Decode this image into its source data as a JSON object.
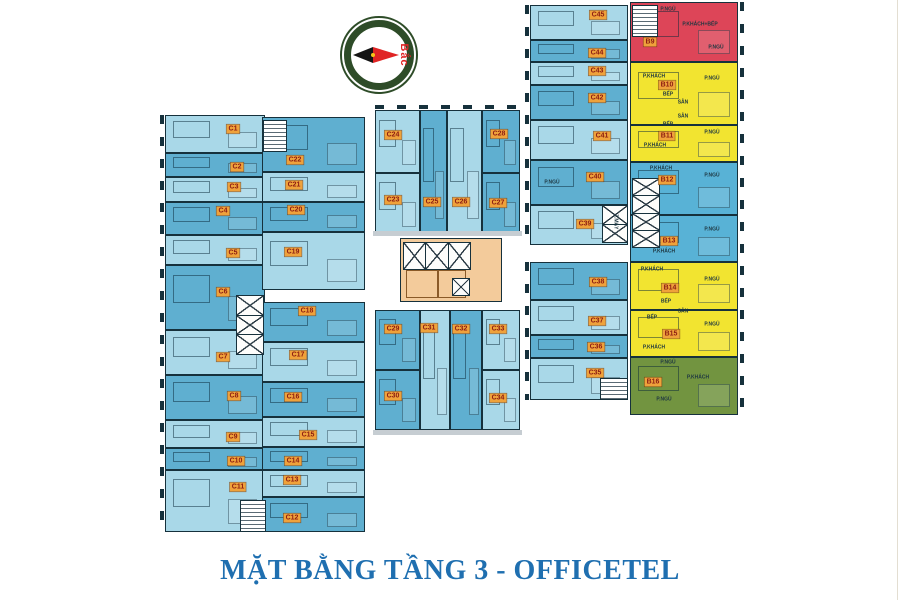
{
  "title": {
    "text": "MẶT BẰNG TẦNG 3 - OFFICETEL",
    "color": "#1f6fb0"
  },
  "compass": {
    "label": "Bắc"
  },
  "colors": {
    "light": "#a9d8e8",
    "mid": "#5fafd0",
    "red": "#dd4558",
    "yellow": "#f2e430",
    "green": "#729440",
    "blue": "#58b2d6",
    "core": "#f3cb9b",
    "wall": "#16313c",
    "badge_bg": "#efa23b",
    "badge_text": "#8c1c12"
  },
  "units": [
    {
      "id": "C1",
      "x": 165,
      "y": 115,
      "w": 100,
      "h": 38,
      "fill": "light",
      "lx": 233,
      "ly": 129
    },
    {
      "id": "C2",
      "x": 165,
      "y": 153,
      "w": 100,
      "h": 24,
      "fill": "mid",
      "lx": 237,
      "ly": 167
    },
    {
      "id": "C3",
      "x": 165,
      "y": 177,
      "w": 100,
      "h": 25,
      "fill": "light",
      "lx": 234,
      "ly": 187
    },
    {
      "id": "C4",
      "x": 165,
      "y": 202,
      "w": 100,
      "h": 33,
      "fill": "mid",
      "lx": 223,
      "ly": 211
    },
    {
      "id": "C5",
      "x": 165,
      "y": 235,
      "w": 100,
      "h": 30,
      "fill": "light",
      "lx": 233,
      "ly": 253
    },
    {
      "id": "C6",
      "x": 165,
      "y": 265,
      "w": 100,
      "h": 65,
      "fill": "mid",
      "lx": 223,
      "ly": 292
    },
    {
      "id": "C7",
      "x": 165,
      "y": 330,
      "w": 100,
      "h": 45,
      "fill": "light",
      "lx": 223,
      "ly": 357
    },
    {
      "id": "C8",
      "x": 165,
      "y": 375,
      "w": 100,
      "h": 45,
      "fill": "mid",
      "lx": 234,
      "ly": 396
    },
    {
      "id": "C9",
      "x": 165,
      "y": 420,
      "w": 100,
      "h": 28,
      "fill": "light",
      "lx": 233,
      "ly": 437
    },
    {
      "id": "C10",
      "x": 165,
      "y": 448,
      "w": 100,
      "h": 22,
      "fill": "mid",
      "lx": 236,
      "ly": 461
    },
    {
      "id": "C11",
      "x": 165,
      "y": 470,
      "w": 100,
      "h": 62,
      "fill": "light",
      "lx": 238,
      "ly": 487
    },
    {
      "id": "C22",
      "x": 262,
      "y": 117,
      "w": 103,
      "h": 55,
      "fill": "mid",
      "lx": 295,
      "ly": 160
    },
    {
      "id": "C21",
      "x": 262,
      "y": 172,
      "w": 103,
      "h": 30,
      "fill": "light",
      "lx": 294,
      "ly": 185
    },
    {
      "id": "C20",
      "x": 262,
      "y": 202,
      "w": 103,
      "h": 30,
      "fill": "mid",
      "lx": 296,
      "ly": 210
    },
    {
      "id": "C19",
      "x": 262,
      "y": 232,
      "w": 103,
      "h": 58,
      "fill": "light",
      "lx": 293,
      "ly": 252
    },
    {
      "id": "C18",
      "x": 262,
      "y": 302,
      "w": 103,
      "h": 40,
      "fill": "mid",
      "lx": 307,
      "ly": 311
    },
    {
      "id": "C17",
      "x": 262,
      "y": 342,
      "w": 103,
      "h": 40,
      "fill": "light",
      "lx": 298,
      "ly": 355
    },
    {
      "id": "C16",
      "x": 262,
      "y": 382,
      "w": 103,
      "h": 35,
      "fill": "mid",
      "lx": 293,
      "ly": 397
    },
    {
      "id": "C15",
      "x": 262,
      "y": 417,
      "w": 103,
      "h": 30,
      "fill": "light",
      "lx": 308,
      "ly": 435
    },
    {
      "id": "C14",
      "x": 262,
      "y": 447,
      "w": 103,
      "h": 23,
      "fill": "mid",
      "lx": 293,
      "ly": 461
    },
    {
      "id": "C13",
      "x": 262,
      "y": 470,
      "w": 103,
      "h": 27,
      "fill": "light",
      "lx": 292,
      "ly": 480
    },
    {
      "id": "C12",
      "x": 262,
      "y": 497,
      "w": 103,
      "h": 35,
      "fill": "mid",
      "lx": 292,
      "ly": 518
    },
    {
      "id": "C24",
      "x": 375,
      "y": 110,
      "w": 45,
      "h": 63,
      "fill": "light",
      "lx": 393,
      "ly": 135
    },
    {
      "id": "C23",
      "x": 375,
      "y": 173,
      "w": 45,
      "h": 62,
      "fill": "light",
      "lx": 393,
      "ly": 200
    },
    {
      "id": "C25",
      "x": 420,
      "y": 110,
      "w": 27,
      "h": 125,
      "fill": "mid",
      "lx": 432,
      "ly": 202
    },
    {
      "id": "C26",
      "x": 447,
      "y": 110,
      "w": 35,
      "h": 125,
      "fill": "light",
      "lx": 461,
      "ly": 202
    },
    {
      "id": "C28",
      "x": 482,
      "y": 110,
      "w": 38,
      "h": 63,
      "fill": "mid",
      "lx": 499,
      "ly": 134
    },
    {
      "id": "C27",
      "x": 482,
      "y": 173,
      "w": 38,
      "h": 62,
      "fill": "mid",
      "lx": 498,
      "ly": 203
    },
    {
      "id": "C29",
      "x": 375,
      "y": 310,
      "w": 45,
      "h": 60,
      "fill": "mid",
      "lx": 393,
      "ly": 329
    },
    {
      "id": "C30",
      "x": 375,
      "y": 370,
      "w": 45,
      "h": 60,
      "fill": "mid",
      "lx": 393,
      "ly": 396
    },
    {
      "id": "C31",
      "x": 420,
      "y": 310,
      "w": 30,
      "h": 120,
      "fill": "light",
      "lx": 429,
      "ly": 328
    },
    {
      "id": "C32",
      "x": 450,
      "y": 310,
      "w": 32,
      "h": 120,
      "fill": "mid",
      "lx": 461,
      "ly": 329
    },
    {
      "id": "C33",
      "x": 482,
      "y": 310,
      "w": 38,
      "h": 60,
      "fill": "light",
      "lx": 498,
      "ly": 329
    },
    {
      "id": "C34",
      "x": 482,
      "y": 370,
      "w": 38,
      "h": 60,
      "fill": "light",
      "lx": 498,
      "ly": 398
    },
    {
      "id": "C45",
      "x": 530,
      "y": 5,
      "w": 98,
      "h": 35,
      "fill": "light",
      "lx": 598,
      "ly": 15
    },
    {
      "id": "C44",
      "x": 530,
      "y": 40,
      "w": 98,
      "h": 22,
      "fill": "mid",
      "lx": 597,
      "ly": 53
    },
    {
      "id": "C43",
      "x": 530,
      "y": 62,
      "w": 98,
      "h": 23,
      "fill": "light",
      "lx": 597,
      "ly": 71
    },
    {
      "id": "C42",
      "x": 530,
      "y": 85,
      "w": 98,
      "h": 35,
      "fill": "mid",
      "lx": 597,
      "ly": 98
    },
    {
      "id": "C41",
      "x": 530,
      "y": 120,
      "w": 98,
      "h": 40,
      "fill": "light",
      "lx": 602,
      "ly": 136
    },
    {
      "id": "C40",
      "x": 530,
      "y": 160,
      "w": 98,
      "h": 45,
      "fill": "mid",
      "lx": 595,
      "ly": 177
    },
    {
      "id": "C39",
      "x": 530,
      "y": 205,
      "w": 98,
      "h": 40,
      "fill": "light",
      "lx": 585,
      "ly": 224
    },
    {
      "id": "C38",
      "x": 530,
      "y": 262,
      "w": 98,
      "h": 38,
      "fill": "mid",
      "lx": 598,
      "ly": 282
    },
    {
      "id": "C37",
      "x": 530,
      "y": 300,
      "w": 98,
      "h": 35,
      "fill": "light",
      "lx": 597,
      "ly": 321
    },
    {
      "id": "C36",
      "x": 530,
      "y": 335,
      "w": 98,
      "h": 23,
      "fill": "mid",
      "lx": 596,
      "ly": 347
    },
    {
      "id": "C35",
      "x": 530,
      "y": 358,
      "w": 98,
      "h": 42,
      "fill": "light",
      "lx": 595,
      "ly": 373
    },
    {
      "id": "B9",
      "x": 630,
      "y": 2,
      "w": 108,
      "h": 60,
      "fill": "red",
      "lx": 650,
      "ly": 42
    },
    {
      "id": "B10",
      "x": 630,
      "y": 62,
      "w": 108,
      "h": 63,
      "fill": "yellow",
      "lx": 667,
      "ly": 85
    },
    {
      "id": "B11",
      "x": 630,
      "y": 125,
      "w": 108,
      "h": 37,
      "fill": "yellow",
      "lx": 667,
      "ly": 136
    },
    {
      "id": "B12",
      "x": 630,
      "y": 162,
      "w": 108,
      "h": 53,
      "fill": "blue",
      "lx": 667,
      "ly": 180
    },
    {
      "id": "B13",
      "x": 630,
      "y": 215,
      "w": 108,
      "h": 47,
      "fill": "blue",
      "lx": 669,
      "ly": 241
    },
    {
      "id": "B14",
      "x": 630,
      "y": 262,
      "w": 108,
      "h": 48,
      "fill": "yellow",
      "lx": 670,
      "ly": 288
    },
    {
      "id": "B15",
      "x": 630,
      "y": 310,
      "w": 108,
      "h": 47,
      "fill": "yellow",
      "lx": 671,
      "ly": 334
    },
    {
      "id": "B16",
      "x": 630,
      "y": 357,
      "w": 108,
      "h": 58,
      "fill": "green",
      "lx": 653,
      "ly": 382
    }
  ],
  "room_labels": [
    {
      "text": "P.NGỦ",
      "x": 668,
      "y": 10
    },
    {
      "text": "P.KHÁCH+BẾP",
      "x": 700,
      "y": 25
    },
    {
      "text": "P.NGỦ",
      "x": 716,
      "y": 48
    },
    {
      "text": "P.KHÁCH",
      "x": 654,
      "y": 77
    },
    {
      "text": "P.NGỦ",
      "x": 712,
      "y": 79
    },
    {
      "text": "BẾP",
      "x": 668,
      "y": 95
    },
    {
      "text": "SÂN",
      "x": 683,
      "y": 103
    },
    {
      "text": "SÂN",
      "x": 683,
      "y": 117
    },
    {
      "text": "BẾP",
      "x": 668,
      "y": 125
    },
    {
      "text": "P.NGỦ",
      "x": 712,
      "y": 133
    },
    {
      "text": "P.KHÁCH",
      "x": 655,
      "y": 146
    },
    {
      "text": "P.KHÁCH",
      "x": 661,
      "y": 169
    },
    {
      "text": "P.NGỦ",
      "x": 712,
      "y": 176
    },
    {
      "text": "P.NGỦ",
      "x": 712,
      "y": 230
    },
    {
      "text": "P.KHÁCH",
      "x": 664,
      "y": 252
    },
    {
      "text": "P.KHÁCH",
      "x": 652,
      "y": 270
    },
    {
      "text": "P.NGỦ",
      "x": 712,
      "y": 280
    },
    {
      "text": "BẾP",
      "x": 666,
      "y": 302
    },
    {
      "text": "SÂN",
      "x": 683,
      "y": 312
    },
    {
      "text": "BẾP",
      "x": 652,
      "y": 318
    },
    {
      "text": "P.NGỦ",
      "x": 712,
      "y": 325
    },
    {
      "text": "P.KHÁCH",
      "x": 654,
      "y": 348
    },
    {
      "text": "P.NGỦ",
      "x": 668,
      "y": 363
    },
    {
      "text": "P.KHÁCH",
      "x": 698,
      "y": 378
    },
    {
      "text": "P.NGỦ",
      "x": 664,
      "y": 400
    },
    {
      "text": "P.NGỦ",
      "x": 552,
      "y": 183
    },
    {
      "text": "T.MÁY",
      "x": 615,
      "y": 222,
      "rot": 90
    }
  ],
  "elevators": [
    {
      "x": 236,
      "y": 295,
      "w": 26,
      "h": 58,
      "cells": 3,
      "dir": "v"
    },
    {
      "x": 403,
      "y": 242,
      "w": 66,
      "h": 26,
      "cells": 3,
      "dir": "h"
    },
    {
      "x": 452,
      "y": 278,
      "w": 16,
      "h": 16,
      "cells": 1,
      "dir": "v"
    },
    {
      "x": 632,
      "y": 178,
      "w": 26,
      "h": 68,
      "cells": 4,
      "dir": "v"
    },
    {
      "x": 602,
      "y": 205,
      "w": 24,
      "h": 36,
      "cells": 2,
      "dir": "v"
    }
  ],
  "stairs": [
    {
      "x": 240,
      "y": 500,
      "w": 24,
      "h": 30
    },
    {
      "x": 263,
      "y": 120,
      "w": 22,
      "h": 30
    },
    {
      "x": 632,
      "y": 5,
      "w": 24,
      "h": 30
    },
    {
      "x": 600,
      "y": 378,
      "w": 26,
      "h": 20
    }
  ],
  "cores": [
    {
      "x": 400,
      "y": 238,
      "w": 100,
      "h": 62
    }
  ],
  "core_rooms": [
    {
      "x": 406,
      "y": 270,
      "w": 30,
      "h": 26
    },
    {
      "x": 438,
      "y": 270,
      "w": 26,
      "h": 26
    }
  ],
  "bars": [
    {
      "x": 373,
      "y": 231,
      "w": 149,
      "h": 5
    },
    {
      "x": 373,
      "y": 430,
      "w": 149,
      "h": 5
    }
  ],
  "ticks": [
    {
      "x": 160,
      "y": 115,
      "w": 4,
      "h": 417,
      "dir": "v"
    },
    {
      "x": 740,
      "y": 2,
      "w": 4,
      "h": 413,
      "dir": "v"
    },
    {
      "x": 525,
      "y": 5,
      "w": 4,
      "h": 240,
      "dir": "v"
    },
    {
      "x": 525,
      "y": 262,
      "w": 4,
      "h": 138,
      "dir": "v"
    },
    {
      "x": 375,
      "y": 105,
      "w": 145,
      "h": 4,
      "dir": "h"
    }
  ]
}
